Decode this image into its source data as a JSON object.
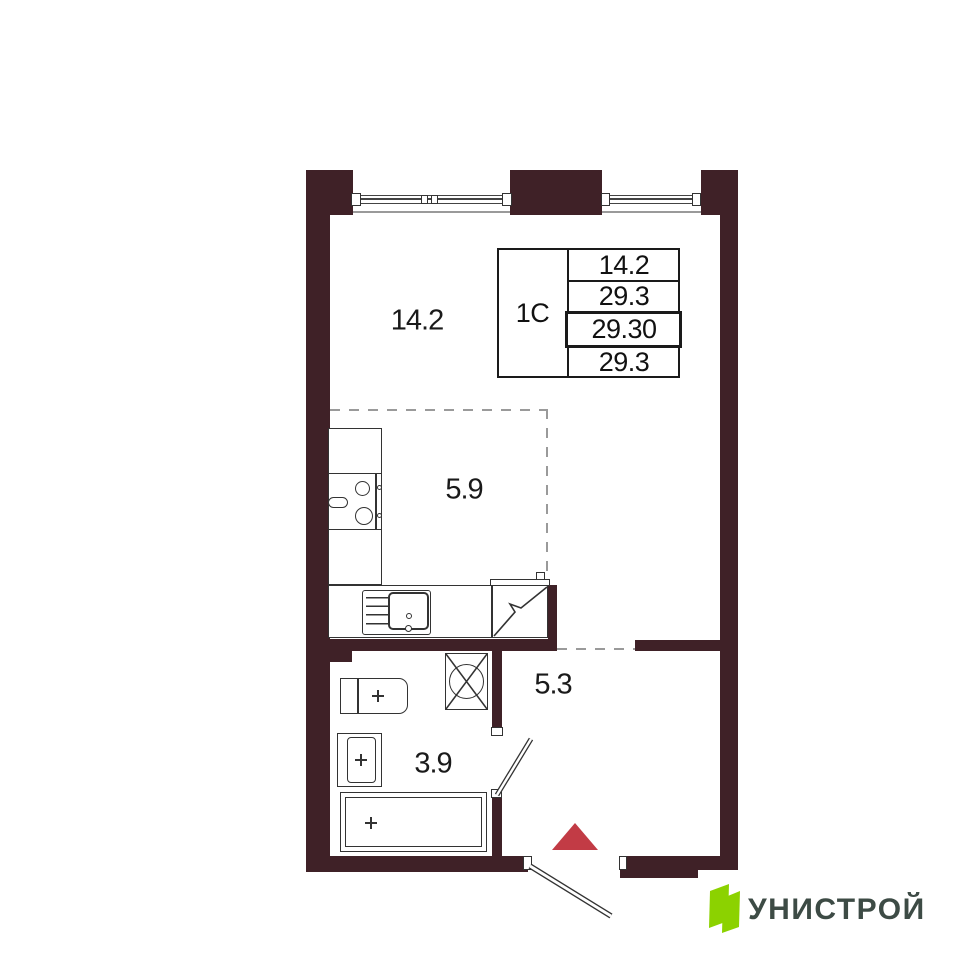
{
  "floor_plan": {
    "unit": {
      "type_label": "1С",
      "table_rows": [
        "14.2",
        "29.3",
        "29.30",
        "29.3"
      ]
    },
    "areas": {
      "living_room": "14.2",
      "kitchen_zone": "5.9",
      "hallway": "5.3",
      "bathroom": "3.9"
    },
    "colors": {
      "wall": "#3f2127",
      "entrance_marker": "#c23b45",
      "logo_green": "#8cd200",
      "logo_text_color": "#3d4b45"
    }
  },
  "branding": {
    "logo_text": "УНИСТРОЙ"
  }
}
